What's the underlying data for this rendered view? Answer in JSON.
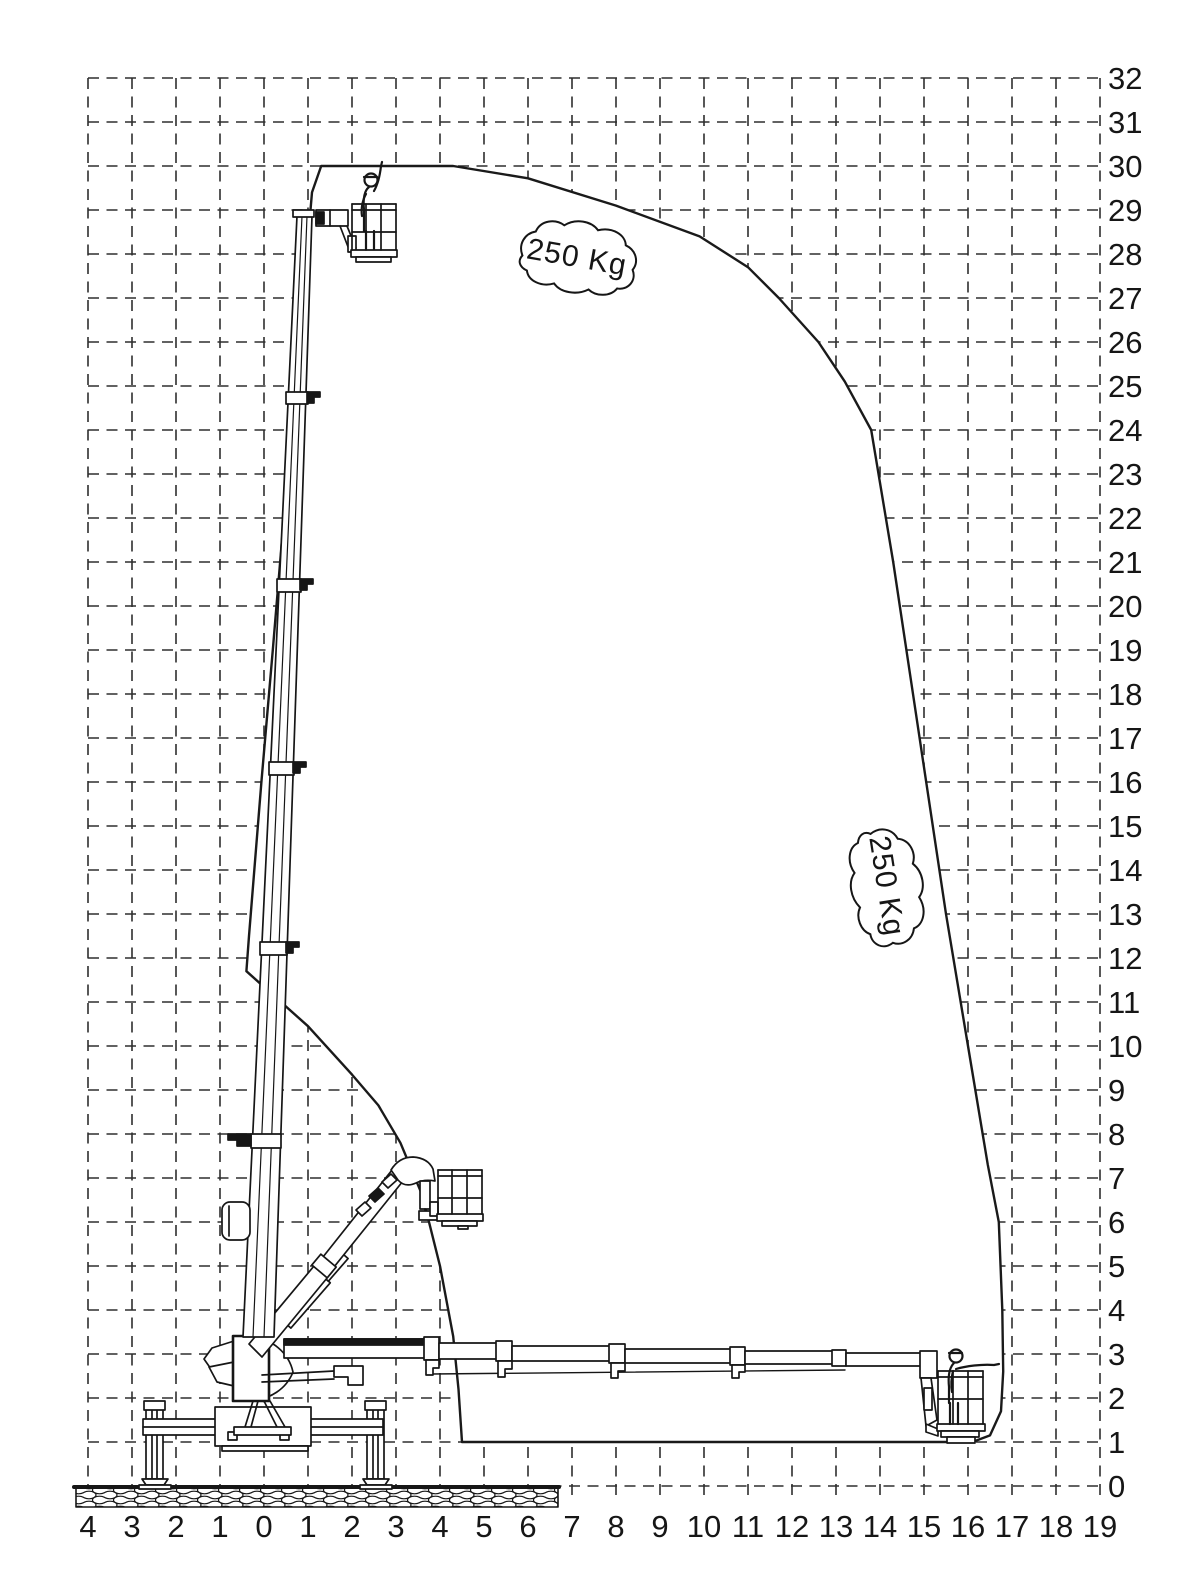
{
  "diagram": {
    "type": "working-envelope-diagram",
    "capacity_labels": [
      {
        "text": "250 Kg"
      },
      {
        "text": "250 Kg"
      }
    ],
    "x_axis": {
      "ticks": [
        "4",
        "3",
        "2",
        "1",
        "0",
        "1",
        "2",
        "3",
        "4",
        "5",
        "6",
        "7",
        "8",
        "9",
        "10",
        "11",
        "12",
        "13",
        "14",
        "15",
        "16",
        "17",
        "18",
        "19"
      ]
    },
    "y_axis": {
      "ticks": [
        "32",
        "31",
        "30",
        "29",
        "28",
        "27",
        "26",
        "25",
        "24",
        "23",
        "22",
        "21",
        "20",
        "19",
        "18",
        "17",
        "16",
        "15",
        "14",
        "13",
        "12",
        "11",
        "10",
        "9",
        "8",
        "7",
        "6",
        "5",
        "4",
        "3",
        "2",
        "1",
        "0"
      ]
    },
    "envelope_outline_m": [
      [
        1.3,
        30
      ],
      [
        4.3,
        30
      ],
      [
        6.0,
        29.72
      ],
      [
        8.0,
        29.1
      ],
      [
        9.9,
        28.4
      ],
      [
        11.0,
        27.7
      ],
      [
        11.7,
        27.0
      ],
      [
        12.6,
        26.0
      ],
      [
        13.2,
        25.1
      ],
      [
        13.8,
        24.0
      ],
      [
        14.3,
        21.0
      ],
      [
        14.9,
        17.0
      ],
      [
        15.5,
        13.0
      ],
      [
        16.0,
        10.0
      ],
      [
        16.45,
        7.3
      ],
      [
        16.7,
        6.0
      ],
      [
        16.78,
        4.0
      ],
      [
        16.8,
        2.6
      ],
      [
        16.75,
        1.7
      ],
      [
        16.5,
        1.15
      ],
      [
        16.1,
        1.0
      ],
      [
        4.5,
        1.0
      ],
      [
        4.42,
        2.2
      ],
      [
        4.3,
        3.4
      ],
      [
        4.0,
        5.0
      ],
      [
        3.6,
        6.6
      ],
      [
        3.1,
        7.8
      ],
      [
        2.6,
        8.65
      ],
      [
        2.0,
        9.35
      ],
      [
        1.0,
        10.45
      ],
      [
        -0.4,
        11.7
      ],
      [
        -0.34,
        12.5
      ],
      [
        -0.06,
        16.0
      ],
      [
        0.2,
        19.0
      ],
      [
        0.45,
        22.0
      ],
      [
        0.71,
        25.0
      ],
      [
        0.97,
        28.0
      ],
      [
        1.09,
        29.4
      ]
    ],
    "max_height_m": 30,
    "max_outreach_m": 16.8
  }
}
